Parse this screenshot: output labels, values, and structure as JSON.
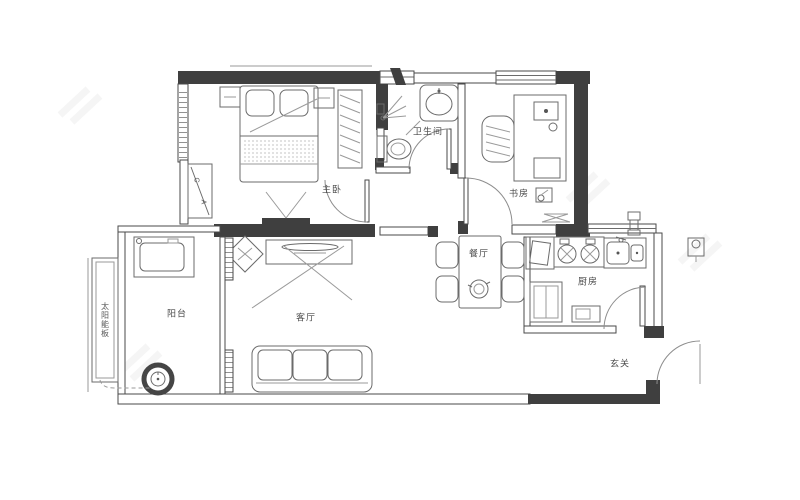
{
  "plan": {
    "labels": {
      "master_bedroom": "主卧",
      "bathroom": "卫生间",
      "study": "书房",
      "dining_room": "餐厅",
      "kitchen": "厨房",
      "living_room": "客厅",
      "balcony": "阳台",
      "entryway": "玄关",
      "solar_panel": "太阳能板",
      "ac_letter_top": "C",
      "ac_letter_bottom": "A"
    },
    "colors": {
      "wall_dark": "#3f3f3f",
      "thin_line": "#4a4a4a",
      "furniture_line": "#6b6b6b",
      "background": "#ffffff"
    }
  }
}
